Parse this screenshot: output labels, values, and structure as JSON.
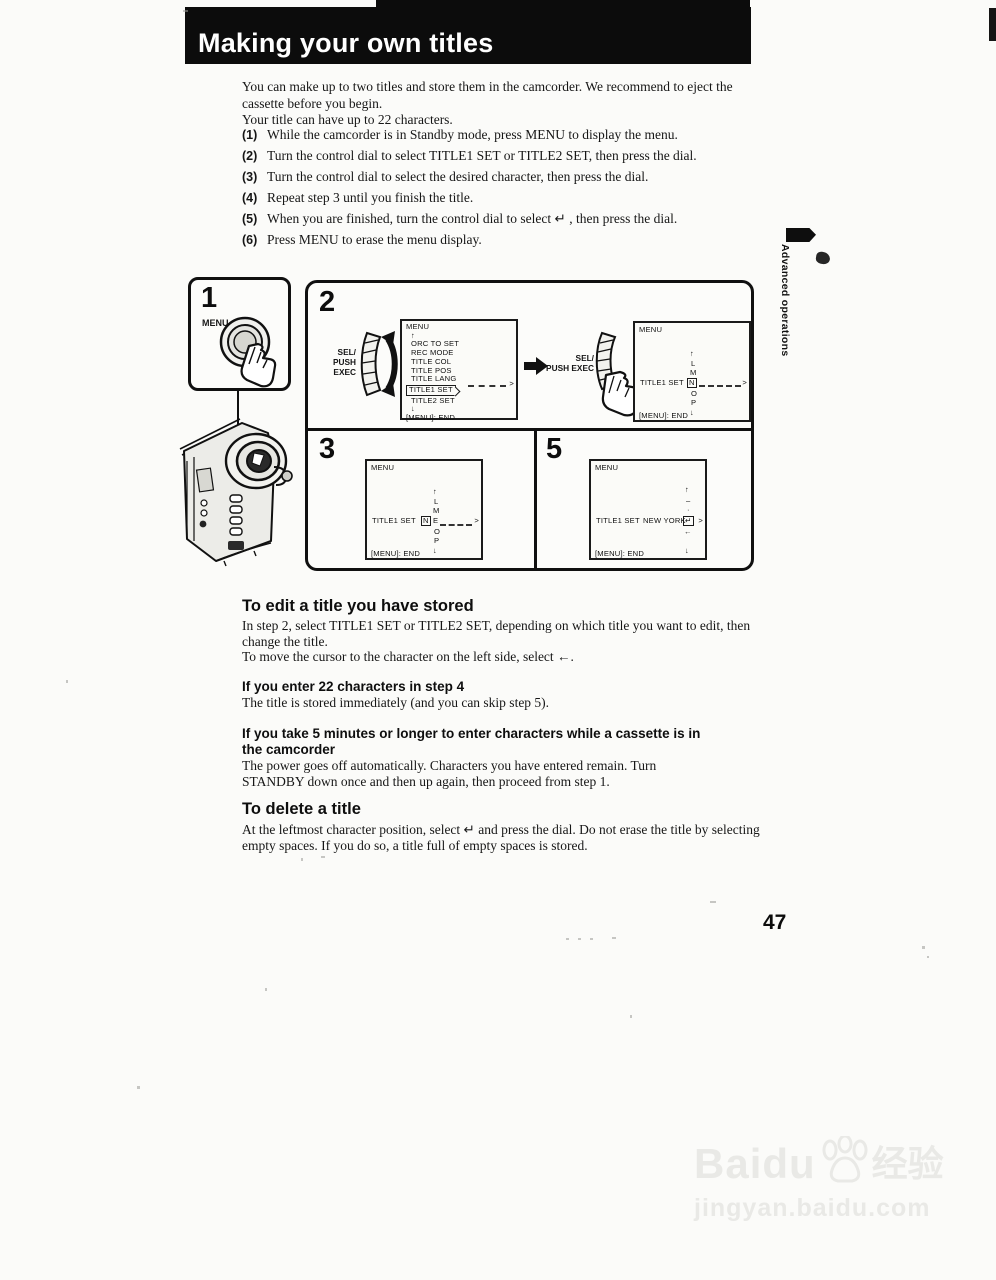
{
  "page": {
    "title": "Making your own titles",
    "page_number": "47"
  },
  "sidebar": {
    "label": "Advanced operations"
  },
  "intro": {
    "p1": "You can make up to two titles and store them in the camcorder.  We recommend to eject the cassette before you begin.",
    "p2": "Your title can have up to 22 characters."
  },
  "steps": [
    {
      "num": "(1)",
      "text": "While the camcorder is in Standby mode, press MENU to display the menu."
    },
    {
      "num": "(2)",
      "text": "Turn the control dial to select TITLE1 SET or TITLE2 SET, then press the dial."
    },
    {
      "num": "(3)",
      "text": "Turn the control dial to select the desired character, then press the dial."
    },
    {
      "num": "(4)",
      "text": "Repeat step 3 until you finish the title."
    },
    {
      "num": "(5)",
      "text": "When you are finished, turn the control dial to select  ↵ , then press the dial."
    },
    {
      "num": "(6)",
      "text": "Press MENU to erase the menu display."
    }
  ],
  "figure": {
    "step1": {
      "num": "1",
      "button_label": "MENU"
    },
    "step2": {
      "num": "2"
    },
    "step3": {
      "num": "3"
    },
    "step5": {
      "num": "5"
    },
    "dial_label_line1": "SEL/",
    "dial_label_line2": "PUSH EXEC",
    "screen1": {
      "title": "MENU",
      "up": "↑",
      "items": [
        "ORC TO SET",
        "REC MODE",
        "TITLE COL",
        "TITLE POS",
        "TITLE LANG"
      ],
      "selected": "TITLE1 SET",
      "item_after": "TITLE2 SET",
      "down": "↓",
      "arrow": ">",
      "footer": "[MENU]: END"
    },
    "screen2": {
      "title": "MENU",
      "above": [
        "↑",
        "L",
        "M"
      ],
      "row_label": "TITLE1 SET",
      "cursor": "N",
      "below": [
        "O",
        "P",
        "↓"
      ],
      "arrow": ">",
      "footer": "[MENU]: END"
    },
    "screen3": {
      "title": "MENU",
      "above": [
        "↑",
        "L",
        "M"
      ],
      "row_label": "TITLE1 SET",
      "entered": "N",
      "cursor": "E",
      "below": [
        "O",
        "P",
        "↓"
      ],
      "arrow": ">",
      "footer": "[MENU]: END"
    },
    "screen5": {
      "title": "MENU",
      "above": [
        "↑",
        "–",
        "·"
      ],
      "row_label": "TITLE1 SET",
      "typed": "NEW YORK",
      "cursor": "↵",
      "below": [
        "←",
        "↓"
      ],
      "arrow": ">",
      "footer": "[MENU]: END"
    }
  },
  "sections": {
    "edit": {
      "heading": "To edit a title you have stored",
      "p1": "In step 2, select TITLE1 SET or TITLE2 SET, depending on which title you want to edit, then change the title.",
      "p2": "To move the cursor to the character on the left side, select ←."
    },
    "enter22": {
      "heading": "If you enter 22 characters in step 4",
      "p": "The title is stored immediately (and you can skip step 5)."
    },
    "five_minutes": {
      "heading": "If you take 5 minutes or longer to enter characters while a cassette is in the camcorder",
      "p": "The power goes off automatically.  Characters you have entered remain.  Turn STANDBY down once and then up again, then proceed from step 1."
    },
    "delete": {
      "heading": "To delete a title",
      "p": "At the leftmost character position, select  ↵  and press the dial.  Do not erase the title by selecting empty spaces.  If you do so, a title full of empty spaces is stored."
    }
  },
  "watermark": {
    "brand": "Baidu",
    "cjk": "经验",
    "url": "jingyan.baidu.com"
  }
}
